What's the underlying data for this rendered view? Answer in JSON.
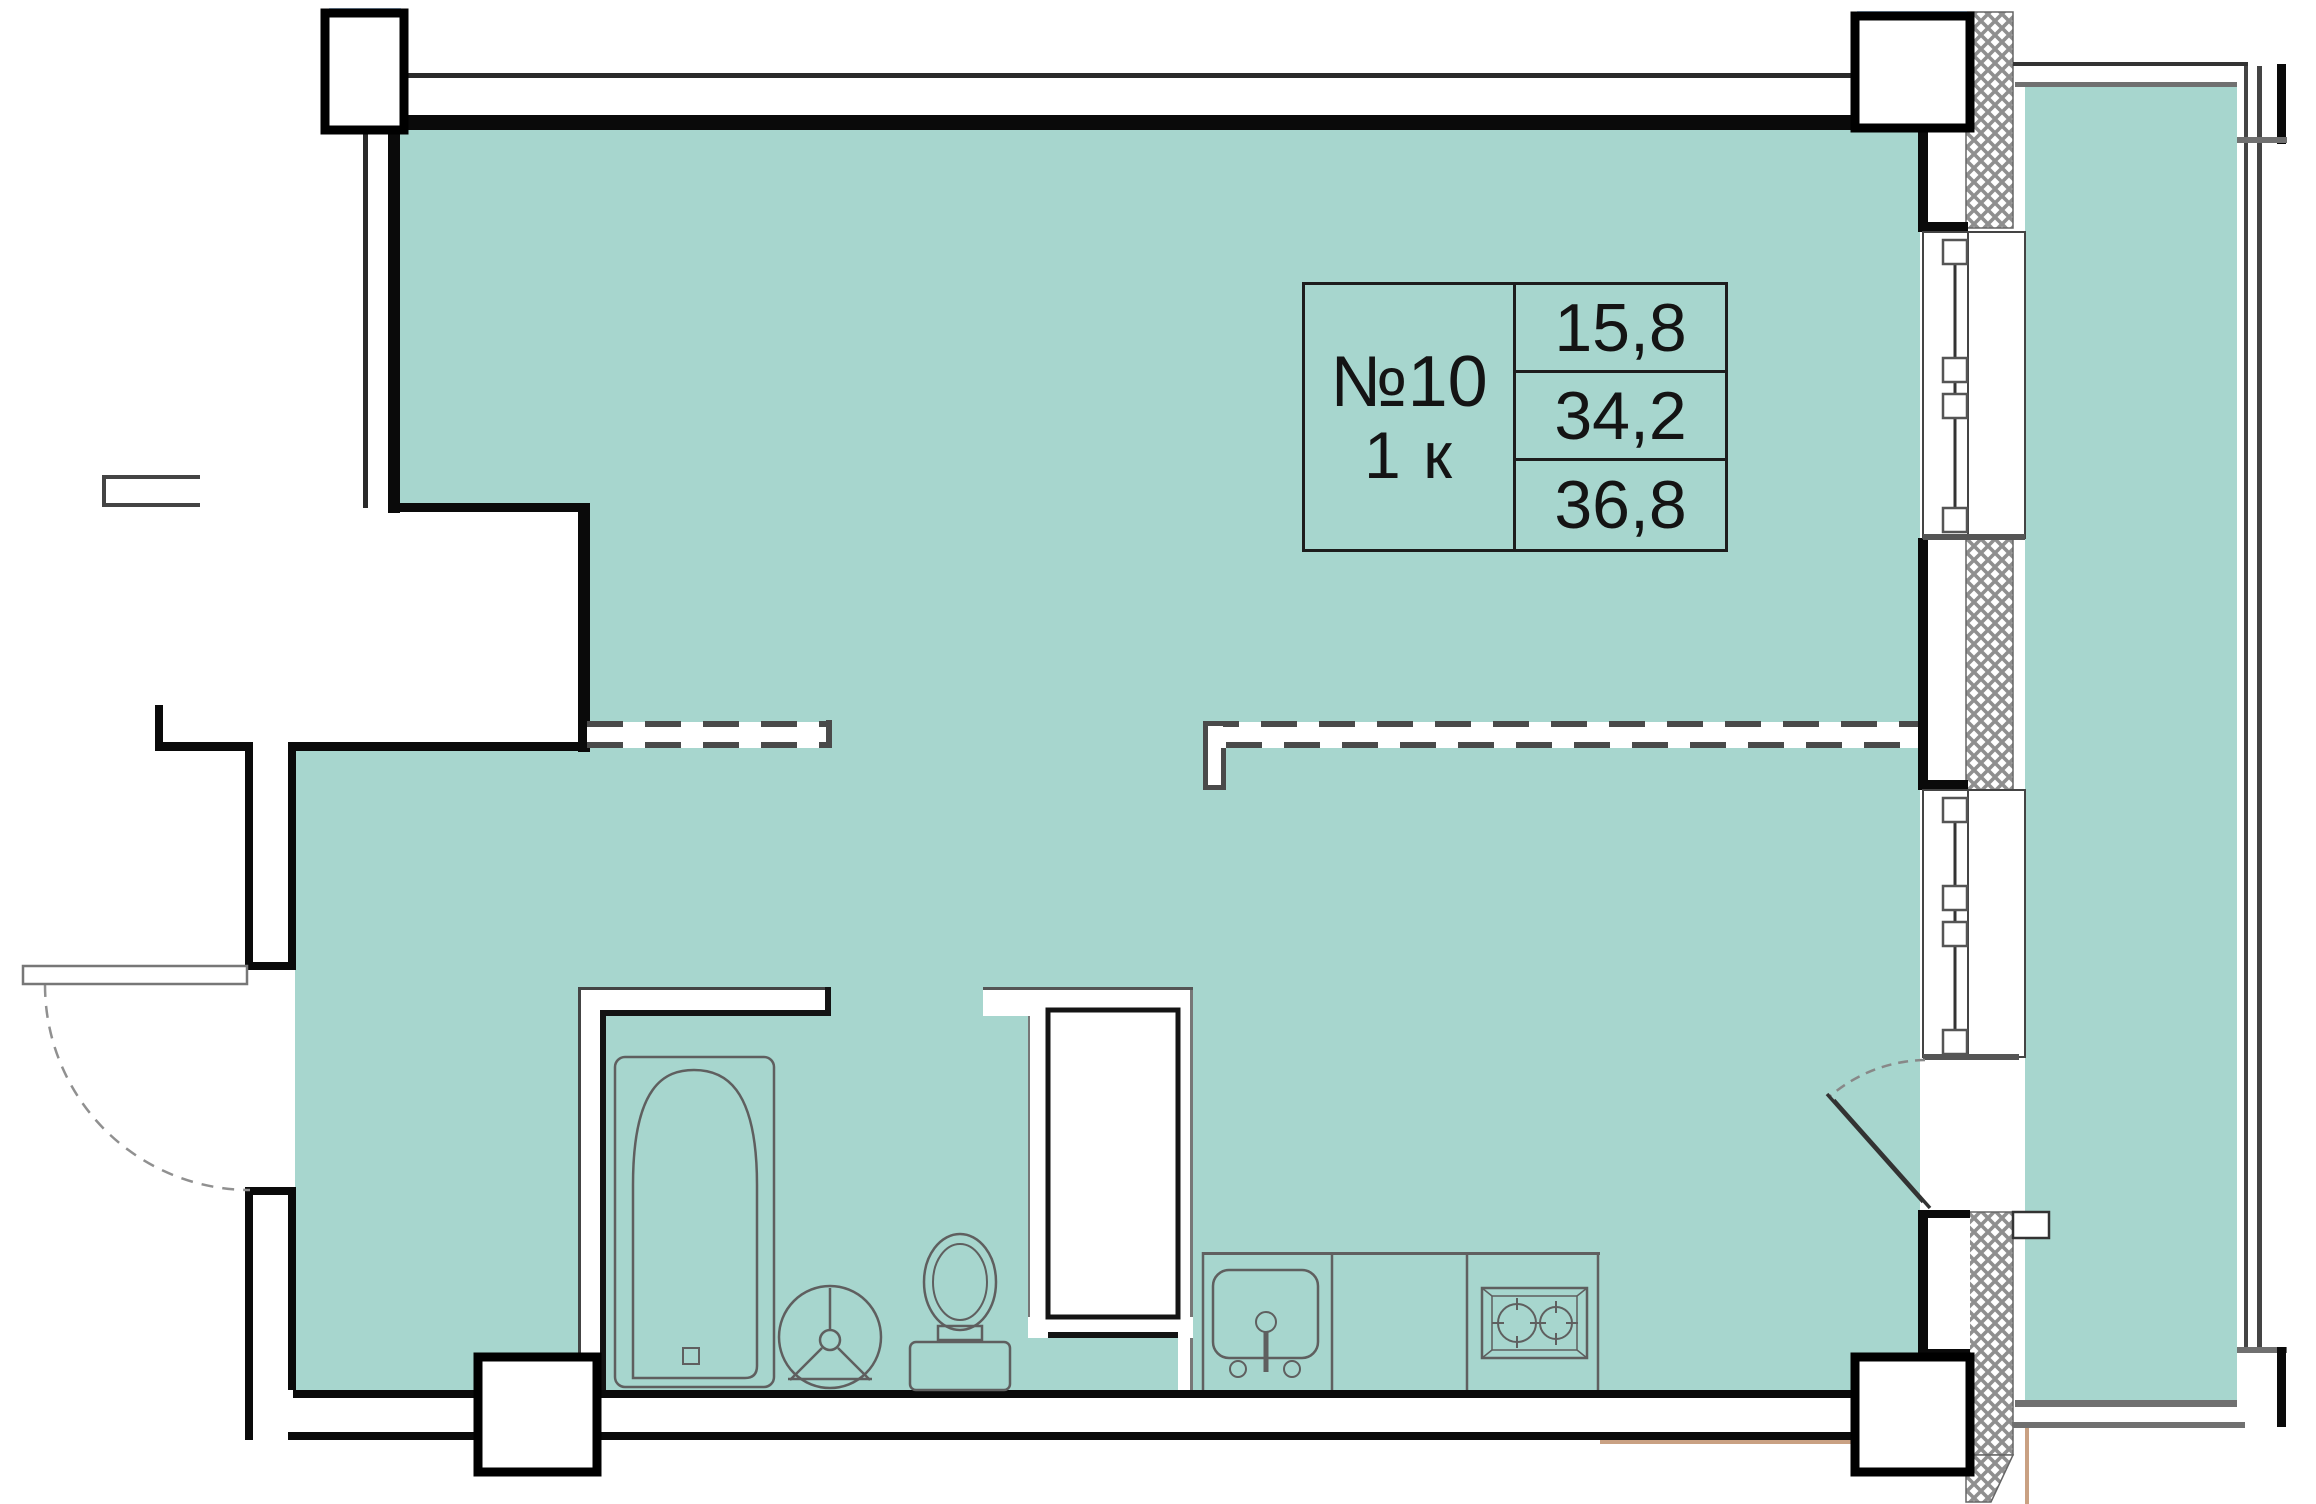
{
  "unit": {
    "number": "№10",
    "rooms": "1 к",
    "areas": [
      "15,8",
      "34,2",
      "36,8"
    ]
  },
  "colors": {
    "floor_fill": "#a7d6ce",
    "wall_black": "#0a0a0a",
    "fixture_line": "#5f5f5f",
    "hatch_line": "#8f8f8f",
    "balcony_line": "#707070",
    "accent_blue": "#a9c9ea",
    "accent_tan": "#c9a183"
  },
  "fixtures": [
    "bathtub",
    "washbasin",
    "toilet",
    "ventilation-shaft",
    "kitchen-sink",
    "stove"
  ]
}
